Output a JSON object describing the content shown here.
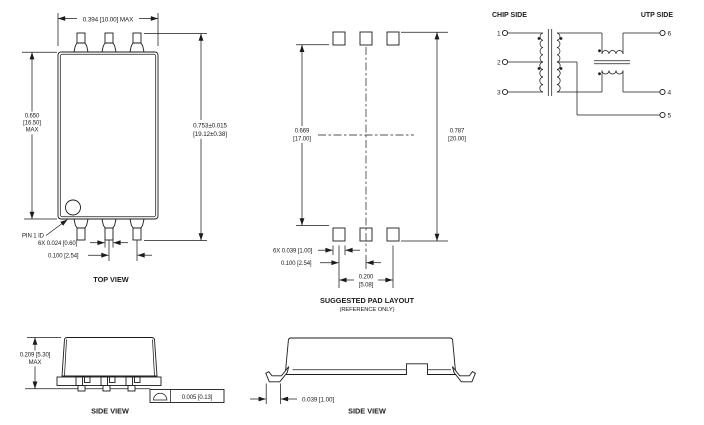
{
  "top_view": {
    "title": "TOP VIEW",
    "dim_width": "0.394 [10.00] MAX",
    "dim_span_in": "0.753±0.015",
    "dim_span_mm": "[19.12±0.38]",
    "dim_height_in": "0.650",
    "dim_height_mm": "[16.50]",
    "dim_height_max": "MAX",
    "pin1_label": "PIN 1 ID",
    "dim_lead_width": "6X  0.024 [0.60]",
    "dim_pitch": "0.100 [2.54]"
  },
  "pad_layout": {
    "title": "SUGGESTED PAD LAYOUT",
    "subtitle": "(REFERENCE ONLY)",
    "dim_inner_in": "0.669",
    "dim_inner_mm": "[17.00]",
    "dim_outer_in": "0.787",
    "dim_outer_mm": "[20.00]",
    "dim_pad_width": "6X  0.039 [1.00]",
    "dim_pitch": "0.100 [2.54]",
    "dim_span_in": "0.200",
    "dim_span_mm": "[5.08]"
  },
  "schematic": {
    "left_label": "CHIP SIDE",
    "right_label": "UTP SIDE",
    "p1": "1",
    "p2": "2",
    "p3": "3",
    "p4": "4",
    "p5": "5",
    "p6": "6"
  },
  "side_view_a": {
    "title": "SIDE VIEW",
    "dim_height": "0.209 [5.30]",
    "dim_height_max": "MAX",
    "flatness": "0.005 [0.13]"
  },
  "side_view_b": {
    "title": "SIDE VIEW",
    "dim_lead": "0.039 [1.00]"
  },
  "colors": {
    "ink": "#1b1b1b",
    "background": "#ffffff"
  }
}
